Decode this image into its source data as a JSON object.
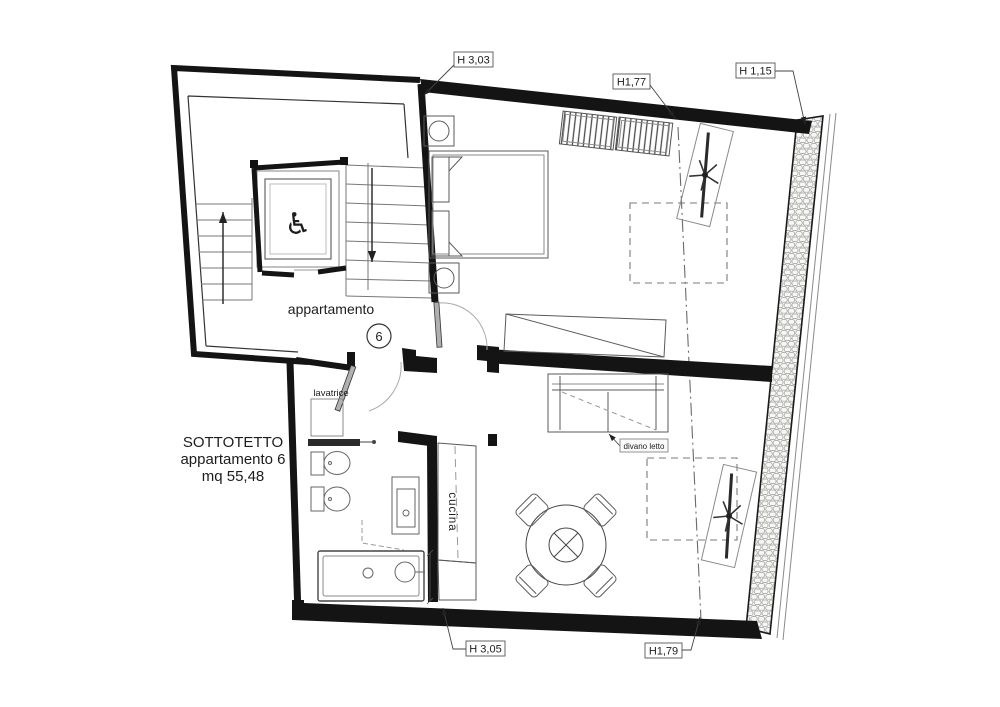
{
  "floor_plan": {
    "summary": {
      "line1": "SOTTOTETTO",
      "line2": "appartamento 6",
      "line3": "mq 55,48"
    },
    "landing": {
      "apartment_label": "appartamento",
      "unit_number": "6"
    },
    "labels": {
      "washing_machine": "lavatrice",
      "kitchen": "cucina",
      "sofa_bed": "divano letto"
    },
    "height_annotations": {
      "top_wall": "H 3,03",
      "ridge_upper": "H1,77",
      "eave_right": "H 1,15",
      "bottom_wall": "H 3,05",
      "ridge_lower": "H1,79"
    },
    "icons": {
      "wheelchair": "♿"
    },
    "colors": {
      "wall": "#1a1a1a",
      "furniture_line": "#5a5a5a",
      "stone_line": "#999999",
      "background": "#ffffff"
    }
  }
}
